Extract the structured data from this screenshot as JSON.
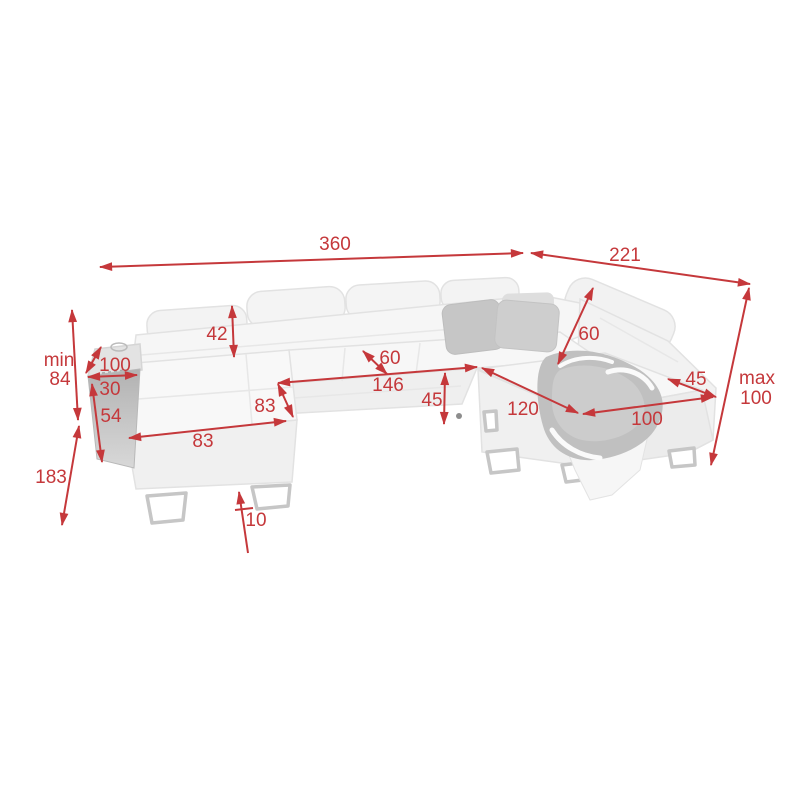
{
  "figure": {
    "subject": "corner sofa dimension diagram",
    "background_color": "#ffffff",
    "accent_color": "#c5383b"
  },
  "sofa": {
    "body_color": "#f5f5f5",
    "edge_color": "#e2e2e2",
    "armrest_panel_color": "#b5b5b5",
    "pillow_color": "#c7c7c7",
    "blanket_color": "#c0c0c0",
    "leg_color": "#c6c6c6"
  },
  "dimensions": {
    "total_width": {
      "label": "360"
    },
    "right_depth": {
      "label": "221"
    },
    "headrest_height": {
      "label": "42"
    },
    "left_armrest_length": {
      "label": "100"
    },
    "left_armrest_width": {
      "label": "30"
    },
    "backrest_min_height": {
      "prefix": "min",
      "value": "84"
    },
    "base_side_height": {
      "label": "54"
    },
    "chaise_depth_total": {
      "label": "183"
    },
    "chaise_seat_depth": {
      "label": "83"
    },
    "chaise_width": {
      "label": "83"
    },
    "seat_cushion_depth": {
      "label": "60"
    },
    "seat_length": {
      "label": "146"
    },
    "seat_height": {
      "label": "45"
    },
    "corner_backrest_height": {
      "label": "60"
    },
    "right_seat_length": {
      "label": "120"
    },
    "right_armrest_width": {
      "label": "45"
    },
    "right_seat_width": {
      "label": "100"
    },
    "backrest_max_height": {
      "prefix": "max",
      "value": "100"
    },
    "leg_height": {
      "label": "10"
    }
  }
}
